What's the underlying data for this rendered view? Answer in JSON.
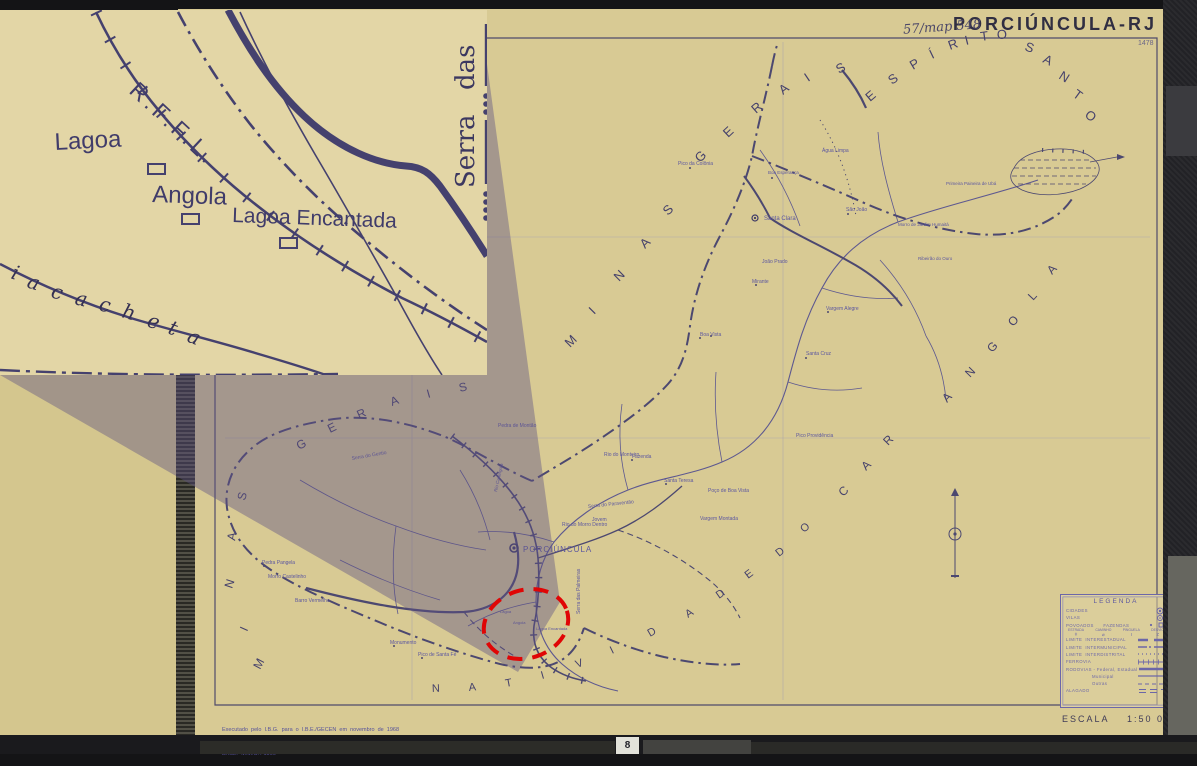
{
  "header": {
    "title": "PORCIÚNCULA-RJ",
    "annotation": "57/map 548",
    "sheet_number": "1478"
  },
  "scale_label": "ESCALA    1:50 000",
  "credits": {
    "line1": "Executado  pelo  I.B.G.  para  o  I.B.E./GECEN  em  novembro  de  1968",
    "line2": "BASE:  M.M.C. / 1966"
  },
  "page_tab": "8",
  "colors": {
    "paper": "#d8ca94",
    "inset_paper": "#e3d6a6",
    "map_ink": "#4c4870",
    "label_ink": "#5b56a0",
    "title_ink": "#302e42",
    "legend_ink": "#6c67a8",
    "highlight_red": "#e00505",
    "cone_overlay": "rgba(92,80,130,0.42)",
    "photo_background": "#141416"
  },
  "legend": {
    "title": "LEGENDA",
    "rows": [
      {
        "label": "CIDADES",
        "sym": "city"
      },
      {
        "label": "VILAS",
        "sym": "vila"
      },
      {
        "label": "POVOADOS      FAZENDAS",
        "sym": "povoado"
      },
      {
        "label": "",
        "sym": "crossings",
        "cols": [
          {
            "t": "ESTRADA",
            "g": "ǂ"
          },
          {
            "t": "CAMINHO",
            "g": "⌀"
          },
          {
            "t": "PINGUELA",
            "g": "I"
          },
          {
            "t": "DESVIO",
            "g": "≠"
          }
        ]
      },
      {
        "label": "LIMITE  INTERESTADUAL",
        "sym": "lim-inter"
      },
      {
        "label": "LIMITE  INTERMUNICIPAL",
        "sym": "lim-mun"
      },
      {
        "label": "LIMITE  INTERDISTRITAL",
        "sym": "lim-dist"
      },
      {
        "label": "FERROVIA",
        "sym": "rail"
      },
      {
        "label": "RODOVIAS - Federal, Estadual",
        "sym": "road1"
      },
      {
        "label": "Municipal",
        "sym": "road2",
        "indent": true
      },
      {
        "label": "Outras",
        "sym": "road3",
        "indent": true
      },
      {
        "label": "ALAGADO",
        "sym": "marsh"
      }
    ]
  },
  "inset": {
    "labels": [
      {
        "t": "R.F.F.L.",
        "x": 128,
        "y": 82,
        "s": 23,
        "r": 43,
        "ls": 4,
        "n": "railway-name-label"
      },
      {
        "t": "Lagoa",
        "x": 55,
        "y": 140,
        "s": 24,
        "r": -3,
        "n": "lagoa-label"
      },
      {
        "t": "Angola",
        "x": 152,
        "y": 192,
        "s": 24,
        "r": 2,
        "n": "angola-label"
      },
      {
        "t": "Lagoa Encantada",
        "x": 232,
        "y": 212,
        "s": 21,
        "r": 2,
        "n": "lagoa-encantada-label"
      },
      {
        "t": "Serra",
        "x": 474,
        "y": 178,
        "s": 26,
        "r": -90,
        "cls": "serif",
        "n": "serra-label"
      },
      {
        "t": "das",
        "x": 474,
        "y": 80,
        "s": 26,
        "r": -90,
        "cls": "serif",
        "n": "das-label"
      },
      {
        "t": "i",
        "x": 10,
        "y": 268,
        "s": 20,
        "r": 20,
        "cls": "script"
      },
      {
        "t": "a",
        "x": 26,
        "y": 277,
        "s": 20,
        "r": 18,
        "cls": "script"
      },
      {
        "t": "c",
        "x": 50,
        "y": 287,
        "s": 20,
        "r": 16,
        "cls": "script"
      },
      {
        "t": "a",
        "x": 74,
        "y": 294,
        "s": 20,
        "r": 14,
        "cls": "script"
      },
      {
        "t": "c",
        "x": 98,
        "y": 300,
        "s": 20,
        "r": 14,
        "cls": "script"
      },
      {
        "t": "h",
        "x": 121,
        "y": 307,
        "s": 20,
        "r": 16,
        "cls": "script"
      },
      {
        "t": "e",
        "x": 146,
        "y": 316,
        "s": 20,
        "r": 18,
        "cls": "script"
      },
      {
        "t": "t",
        "x": 167,
        "y": 323,
        "s": 20,
        "r": 20,
        "cls": "script"
      },
      {
        "t": "a",
        "x": 186,
        "y": 331,
        "s": 20,
        "r": 22,
        "cls": "script"
      }
    ]
  },
  "region_letterings": [
    {
      "name": "espirito-santo",
      "size": 13,
      "letters": [
        {
          "t": "E",
          "x": 870,
          "y": 102,
          "r": -40
        },
        {
          "t": "S",
          "x": 892,
          "y": 85,
          "r": -36
        },
        {
          "t": "P",
          "x": 913,
          "y": 70,
          "r": -31
        },
        {
          "t": "Í",
          "x": 932,
          "y": 59,
          "r": -26
        },
        {
          "t": "R",
          "x": 950,
          "y": 50,
          "r": -20
        },
        {
          "t": "I",
          "x": 966,
          "y": 45,
          "r": -14
        },
        {
          "t": "T",
          "x": 981,
          "y": 41,
          "r": -8
        },
        {
          "t": "O",
          "x": 997,
          "y": 39,
          "r": -2
        },
        {
          "t": "S",
          "x": 1024,
          "y": 50,
          "r": 20
        },
        {
          "t": "A",
          "x": 1042,
          "y": 62,
          "r": 26
        },
        {
          "t": "N",
          "x": 1058,
          "y": 78,
          "r": 32
        },
        {
          "t": "T",
          "x": 1072,
          "y": 96,
          "r": 36
        },
        {
          "t": "O",
          "x": 1084,
          "y": 116,
          "r": 40
        }
      ]
    },
    {
      "name": "minas-gerais-upper",
      "size": 13,
      "letters": [
        {
          "t": "M",
          "x": 570,
          "y": 348,
          "r": -45
        },
        {
          "t": "I",
          "x": 594,
          "y": 315,
          "r": -45
        },
        {
          "t": "N",
          "x": 619,
          "y": 282,
          "r": -45
        },
        {
          "t": "A",
          "x": 645,
          "y": 249,
          "r": -45
        },
        {
          "t": "S",
          "x": 668,
          "y": 216,
          "r": -45
        },
        {
          "t": "G",
          "x": 700,
          "y": 163,
          "r": -45
        },
        {
          "t": "E",
          "x": 728,
          "y": 138,
          "r": -43
        },
        {
          "t": "R",
          "x": 756,
          "y": 114,
          "r": -41
        },
        {
          "t": "A",
          "x": 783,
          "y": 95,
          "r": -38
        },
        {
          "t": "I",
          "x": 808,
          "y": 82,
          "r": -34
        },
        {
          "t": "S",
          "x": 839,
          "y": 74,
          "r": -30
        }
      ]
    },
    {
      "name": "minas-lower",
      "size": 12,
      "letters": [
        {
          "t": "M",
          "x": 260,
          "y": 670,
          "r": -62
        },
        {
          "t": "I",
          "x": 247,
          "y": 632,
          "r": -66
        },
        {
          "t": "N",
          "x": 232,
          "y": 589,
          "r": -72
        },
        {
          "t": "A",
          "x": 235,
          "y": 541,
          "r": -80
        },
        {
          "t": "S",
          "x": 245,
          "y": 501,
          "r": -75
        }
      ]
    },
    {
      "name": "gerais-lower",
      "size": 12,
      "letters": [
        {
          "t": "G",
          "x": 299,
          "y": 450,
          "r": -28
        },
        {
          "t": "E",
          "x": 330,
          "y": 433,
          "r": -26
        },
        {
          "t": "R",
          "x": 359,
          "y": 419,
          "r": -24
        },
        {
          "t": "A",
          "x": 392,
          "y": 406,
          "r": -20
        },
        {
          "t": "I",
          "x": 428,
          "y": 398,
          "r": -16
        },
        {
          "t": "S",
          "x": 460,
          "y": 392,
          "r": -14
        }
      ]
    },
    {
      "name": "natividade",
      "size": 11,
      "letters": [
        {
          "t": "N",
          "x": 432,
          "y": 692,
          "r": -2
        },
        {
          "t": "A",
          "x": 469,
          "y": 691,
          "r": -6
        },
        {
          "t": "T",
          "x": 506,
          "y": 687,
          "r": -11
        },
        {
          "t": "I",
          "x": 542,
          "y": 679,
          "r": -16
        },
        {
          "t": "V",
          "x": 577,
          "y": 668,
          "r": -21
        },
        {
          "t": "I",
          "x": 612,
          "y": 654,
          "r": -26
        },
        {
          "t": "D",
          "x": 650,
          "y": 637,
          "r": -30
        },
        {
          "t": "A",
          "x": 688,
          "y": 618,
          "r": -33
        },
        {
          "t": "D",
          "x": 719,
          "y": 599,
          "r": -35
        },
        {
          "t": "E",
          "x": 748,
          "y": 579,
          "r": -37
        }
      ]
    },
    {
      "name": "do",
      "size": 11,
      "letters": [
        {
          "t": "D",
          "x": 779,
          "y": 557,
          "r": -39
        },
        {
          "t": "O",
          "x": 804,
          "y": 533,
          "r": -41
        }
      ]
    },
    {
      "name": "carangola",
      "size": 12,
      "letters": [
        {
          "t": "C",
          "x": 843,
          "y": 497,
          "r": -43
        },
        {
          "t": "A",
          "x": 866,
          "y": 471,
          "r": -44
        },
        {
          "t": "R",
          "x": 888,
          "y": 446,
          "r": -45
        },
        {
          "t": "A",
          "x": 947,
          "y": 403,
          "r": -46
        },
        {
          "t": "N",
          "x": 970,
          "y": 378,
          "r": -46
        },
        {
          "t": "G",
          "x": 992,
          "y": 353,
          "r": -46
        },
        {
          "t": "O",
          "x": 1013,
          "y": 327,
          "r": -47
        },
        {
          "t": "L",
          "x": 1033,
          "y": 301,
          "r": -47
        },
        {
          "t": "A",
          "x": 1052,
          "y": 275,
          "r": -47
        }
      ]
    }
  ],
  "place_labels": [
    {
      "t": "Santa Clara",
      "x": 764,
      "y": 220,
      "s": 6
    },
    {
      "t": "PORCIÚNCULA",
      "x": 523,
      "y": 552,
      "s": 8,
      "ls": 1
    },
    {
      "t": "Pedra de Montão",
      "x": 498,
      "y": 427,
      "s": 5
    },
    {
      "t": "Rio do Monteiro",
      "x": 604,
      "y": 456,
      "s": 5
    },
    {
      "t": "Serra do Paraventão",
      "x": 588,
      "y": 508,
      "s": 5,
      "r": -6
    },
    {
      "t": "Jovem",
      "x": 592,
      "y": 521,
      "s": 5
    },
    {
      "t": "Rio do Morro Dentro",
      "x": 562,
      "y": 526,
      "s": 5
    },
    {
      "t": "Serra das Palmeiras",
      "x": 580,
      "y": 614,
      "s": 5,
      "r": -90
    },
    {
      "t": "Lagoa",
      "x": 500,
      "y": 613,
      "s": 4
    },
    {
      "t": "Angola",
      "x": 513,
      "y": 624,
      "s": 4
    },
    {
      "t": "Lagoa Encantada",
      "x": 536,
      "y": 630,
      "s": 4
    },
    {
      "t": "Pico de Santa Fé",
      "x": 418,
      "y": 656,
      "s": 5
    },
    {
      "t": "Monumento",
      "x": 390,
      "y": 644,
      "s": 5
    },
    {
      "t": "Pedra Pangela",
      "x": 262,
      "y": 564,
      "s": 5
    },
    {
      "t": "Morro Castelinho",
      "x": 268,
      "y": 578,
      "s": 5
    },
    {
      "t": "Barro Vermelho",
      "x": 295,
      "y": 602,
      "s": 5
    },
    {
      "t": "Serra do Gentio",
      "x": 352,
      "y": 460,
      "s": 5,
      "r": -10
    },
    {
      "t": "Boa Vista",
      "x": 700,
      "y": 336,
      "s": 5
    },
    {
      "t": "Mirante",
      "x": 752,
      "y": 283,
      "s": 5
    },
    {
      "t": "João Prado",
      "x": 762,
      "y": 263,
      "s": 5
    },
    {
      "t": "São João",
      "x": 846,
      "y": 211,
      "s": 5
    },
    {
      "t": "Água Limpa",
      "x": 822,
      "y": 152,
      "s": 5
    },
    {
      "t": "Boa Esperança",
      "x": 768,
      "y": 174,
      "s": 4.5
    },
    {
      "t": "Pico da Colônia",
      "x": 678,
      "y": 165,
      "s": 5
    },
    {
      "t": "Santa Cruz",
      "x": 806,
      "y": 355,
      "s": 5
    },
    {
      "t": "Vargem Alegre",
      "x": 826,
      "y": 310,
      "s": 5
    },
    {
      "t": "Ribeirão do Ouro",
      "x": 918,
      "y": 260,
      "s": 4.5
    },
    {
      "t": "Primeira Paineira de Ubá",
      "x": 946,
      "y": 185,
      "s": 4.5
    },
    {
      "t": "Morro de Jardim Humaitá",
      "x": 898,
      "y": 226,
      "s": 4.5
    },
    {
      "t": "Pico Providência",
      "x": 796,
      "y": 437,
      "s": 5
    },
    {
      "t": "Fazenda",
      "x": 632,
      "y": 458,
      "s": 5
    },
    {
      "t": "Santa Teresa",
      "x": 664,
      "y": 482,
      "s": 5
    },
    {
      "t": "Poço de Boa Vista",
      "x": 708,
      "y": 492,
      "s": 5
    },
    {
      "t": "Vargem Montada",
      "x": 700,
      "y": 520,
      "s": 5
    },
    {
      "t": "Rio Carangola",
      "x": 497,
      "y": 492,
      "s": 4.5,
      "r": -78
    }
  ]
}
